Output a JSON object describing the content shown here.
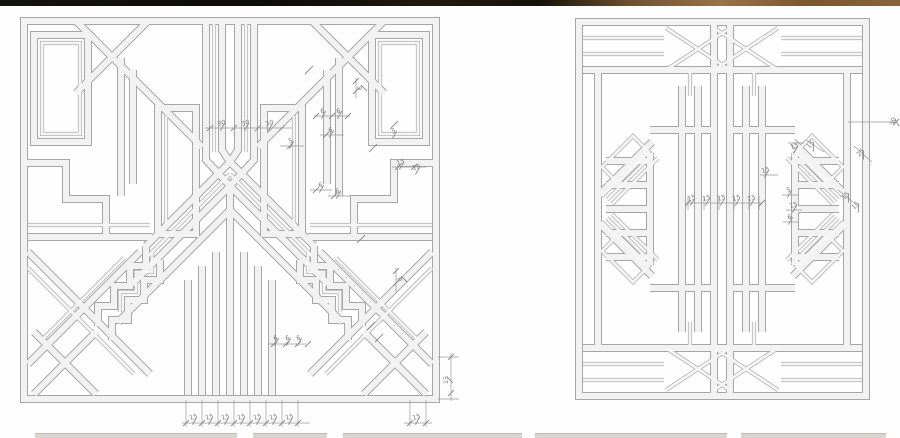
{
  "page": {
    "background": "#ffffff"
  },
  "photo_strip_top": {
    "description": "dark photo edge sliver",
    "colors": [
      "#131210",
      "#0c0b09",
      "#23190f",
      "#6e4f30",
      "#9a7347",
      "#8a643c"
    ]
  },
  "thumbnail_strip_bottom": {
    "color": "#d7d4d2",
    "segments_x": [
      [
        35,
        237
      ],
      [
        253,
        327
      ],
      [
        343,
        522
      ],
      [
        535,
        727
      ],
      [
        741,
        886
      ]
    ]
  },
  "drawing": {
    "stroke": "#a6a6a6",
    "bar_fill": "#f2f2f2",
    "dim_line_color": "#9a9a9a",
    "dim_text_color": "#7c7c7c",
    "panels": [
      {
        "id": "left-grille",
        "name": "art-deco grille elevation, square panel",
        "dimensions": [
          {
            "x": 222,
            "y": 125,
            "rot": -15,
            "text": "30"
          },
          {
            "x": 246,
            "y": 125,
            "rot": -15,
            "text": "30"
          },
          {
            "x": 270,
            "y": 125,
            "rot": -15,
            "text": "30"
          },
          {
            "x": 362,
            "y": 88,
            "rot": -90,
            "text": "6"
          },
          {
            "x": 323,
            "y": 113,
            "rot": -15,
            "text": "6"
          },
          {
            "x": 339,
            "y": 113,
            "rot": -15,
            "text": "6"
          },
          {
            "x": 331,
            "y": 132,
            "rot": -15,
            "text": "6"
          },
          {
            "x": 291,
            "y": 143,
            "rot": -15,
            "text": "5"
          },
          {
            "x": 394,
            "y": 133,
            "rot": -15,
            "text": "5"
          },
          {
            "x": 401,
            "y": 164,
            "rot": -15,
            "text": "15"
          },
          {
            "x": 417,
            "y": 169,
            "rot": -15,
            "text": "15"
          },
          {
            "x": 321,
            "y": 187,
            "rot": -15,
            "text": "6"
          },
          {
            "x": 338,
            "y": 193,
            "rot": -15,
            "text": "6"
          },
          {
            "x": 402,
            "y": 279,
            "rot": -90,
            "text": "6"
          },
          {
            "x": 276,
            "y": 340,
            "rot": -15,
            "text": "6"
          },
          {
            "x": 288,
            "y": 340,
            "rot": -15,
            "text": "6"
          },
          {
            "x": 299,
            "y": 340,
            "rot": -15,
            "text": "6"
          },
          {
            "x": 194,
            "y": 419,
            "rot": -15,
            "text": "15"
          },
          {
            "x": 210,
            "y": 419,
            "rot": -15,
            "text": "15"
          },
          {
            "x": 226,
            "y": 419,
            "rot": -15,
            "text": "15"
          },
          {
            "x": 242,
            "y": 419,
            "rot": -15,
            "text": "15"
          },
          {
            "x": 258,
            "y": 419,
            "rot": -15,
            "text": "15"
          },
          {
            "x": 274,
            "y": 419,
            "rot": -15,
            "text": "15"
          },
          {
            "x": 290,
            "y": 419,
            "rot": -15,
            "text": "15"
          },
          {
            "x": 417,
            "y": 419,
            "rot": -15,
            "text": "15"
          },
          {
            "x": 448,
            "y": 380,
            "rot": -90,
            "text": "15"
          }
        ]
      },
      {
        "id": "right-grille",
        "name": "art-deco grille elevation, rectangular panel",
        "dimensions": [
          {
            "x": 692,
            "y": 200,
            "rot": -15,
            "text": "15"
          },
          {
            "x": 707,
            "y": 200,
            "rot": -15,
            "text": "15"
          },
          {
            "x": 722,
            "y": 200,
            "rot": -15,
            "text": "15"
          },
          {
            "x": 737,
            "y": 200,
            "rot": -15,
            "text": "15"
          },
          {
            "x": 752,
            "y": 200,
            "rot": -15,
            "text": "15"
          },
          {
            "x": 895,
            "y": 122,
            "rot": -75,
            "text": "30"
          },
          {
            "x": 812,
            "y": 146,
            "rot": -45,
            "text": "15"
          },
          {
            "x": 862,
            "y": 154,
            "rot": -45,
            "text": "25"
          },
          {
            "x": 795,
            "y": 148,
            "rot": -15,
            "text": "15"
          },
          {
            "x": 766,
            "y": 172,
            "rot": -15,
            "text": "15"
          },
          {
            "x": 789,
            "y": 192,
            "rot": -15,
            "text": "5"
          },
          {
            "x": 794,
            "y": 207,
            "rot": -15,
            "text": "15"
          },
          {
            "x": 790,
            "y": 219,
            "rot": -15,
            "text": "6"
          },
          {
            "x": 847,
            "y": 197,
            "rot": -45,
            "text": "15"
          },
          {
            "x": 857,
            "y": 207,
            "rot": -45,
            "text": "15"
          }
        ]
      }
    ]
  }
}
